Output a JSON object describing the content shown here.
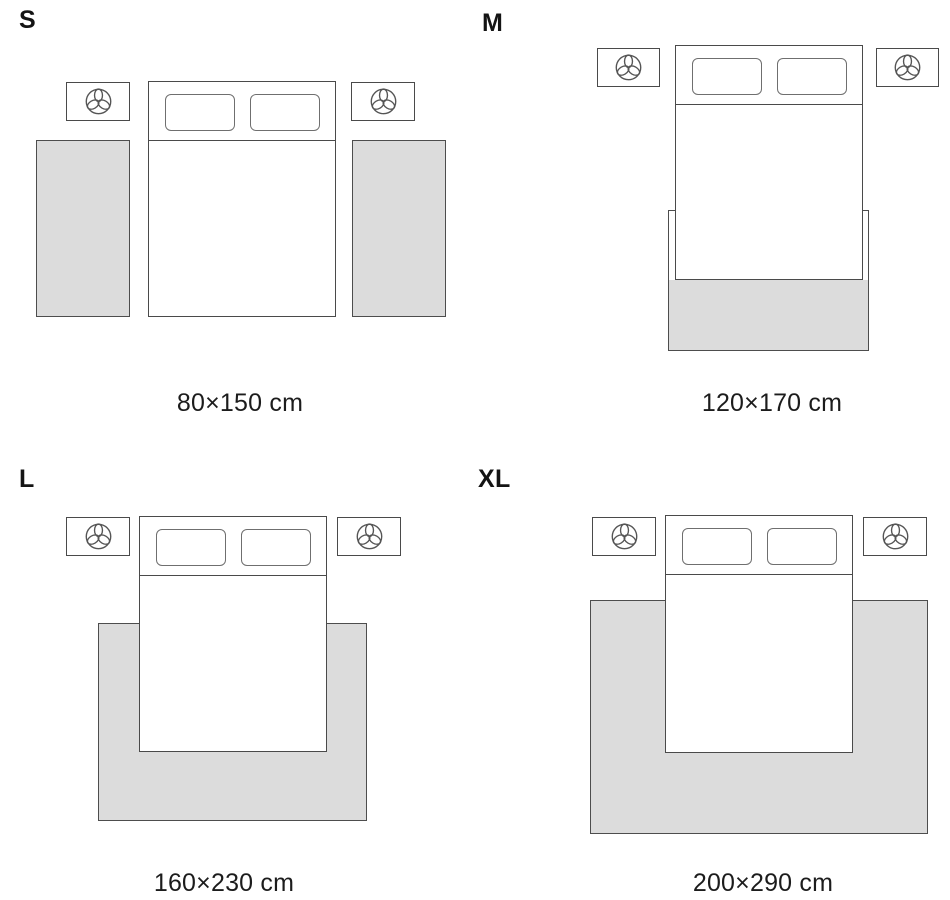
{
  "sizes": [
    {
      "label": "S",
      "dimensions": "80×150 cm"
    },
    {
      "label": "M",
      "dimensions": "120×170 cm"
    },
    {
      "label": "L",
      "dimensions": "160×230 cm"
    },
    {
      "label": "XL",
      "dimensions": "200×290 cm"
    }
  ],
  "icons": {
    "nightstand_icon": "plant-top-view"
  },
  "colors": {
    "background": "#ffffff",
    "rug_fill": "#dcdcdc",
    "outline": "#4a4a4a",
    "pillow_outline": "#6f6f6f",
    "text": "#1c1c1c"
  }
}
